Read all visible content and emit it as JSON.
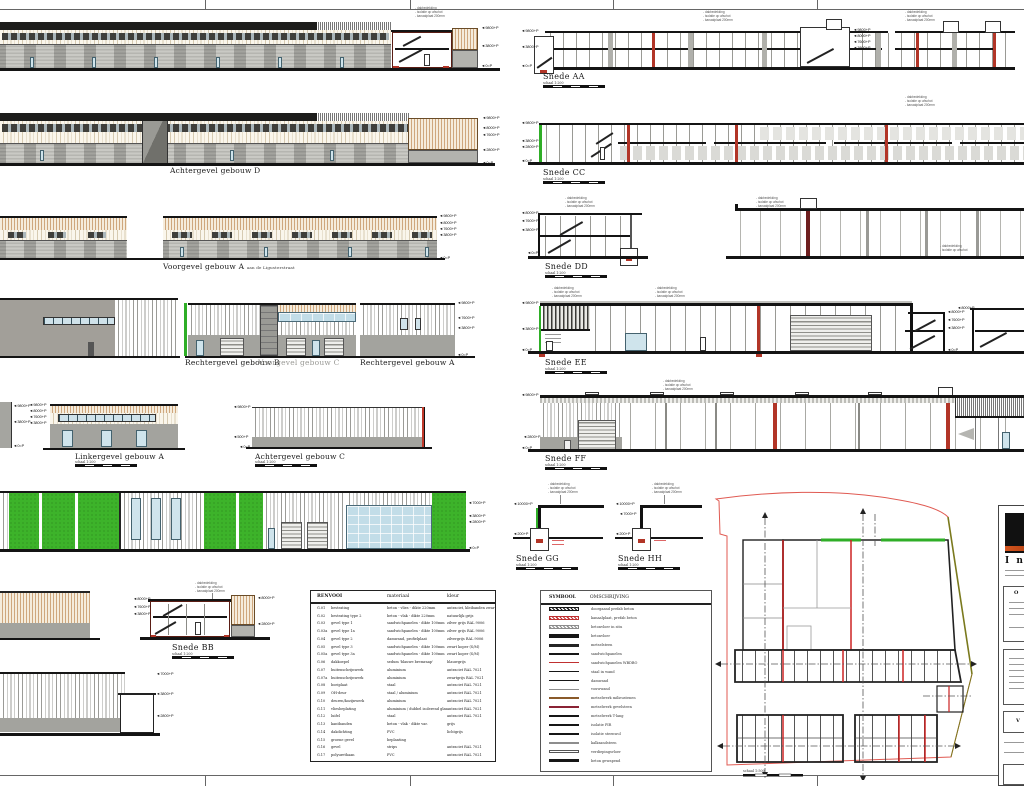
{
  "labels": {
    "achtergevel_d": "Achtergevel gebouw D",
    "voorgevel_a": "Voorgevel gebouw A",
    "voorgevel_a_suffix": "aan de Ligusterstraat",
    "rechtergevel_b": "Rechtergevel gebouw B",
    "voorgevel_c": "Voorgevel gebouw C",
    "rechtergevel_a": "Rechtergevel gebouw A",
    "linkergevel_a": "Linkergevel gebouw A",
    "achtergevel_c": "Achtergevel gebouw C"
  },
  "sections": {
    "aa": "Snede AA",
    "bb": "Snede BB",
    "cc": "Snede CC",
    "dd": "Snede DD",
    "ee": "Snede EE",
    "ff": "Snede FF",
    "gg": "Snede GG",
    "hh": "Snede HH"
  },
  "scale": {
    "label": "schaal 1:200",
    "site_label": "schaal 1:500",
    "unit": "10m"
  },
  "levels": {
    "p10000": "10000+P",
    "p9800": "9800+P",
    "p8000": "8000+P",
    "p7600": "7600+P",
    "p7000": "7000+P",
    "p3800": "3800+P",
    "p2800": "2800+P",
    "p500": "500+P",
    "p200": "200+P",
    "p0": "0=P"
  },
  "ann": {
    "l1": "- dakbedekking",
    "l2": "- isolatie op afschot",
    "l3": "- kanaalplaat 200mm"
  },
  "renvooi": {
    "title": "RENVOOI",
    "col_materiaal": "materiaal",
    "col_kleur": "kleur",
    "rows": [
      [
        "G.01",
        "bestrating",
        "beton - vlies - dikte 220mm",
        "antraciet, kleibanden zwart"
      ],
      [
        "G.02",
        "bestrating type 2",
        "beton - vlak - dikte 220mm",
        "natuurlijk grijs"
      ],
      [
        "G.03",
        "gevel type 1",
        "sandwichpanelen - dikte 100mm",
        "zilver grijs RAL 9006"
      ],
      [
        "G.03a",
        "gevel type 1a",
        "sandwichpanelen - dikte 100mm",
        "zilver grijs RAL 9006"
      ],
      [
        "G.04",
        "gevel type 2",
        "damwand, profielplaat",
        "zilvergrijs RAL 9006"
      ],
      [
        "G.05",
        "gevel type 3",
        "sandwichpanelen - dikte 100mm",
        "zwart koper (S/M)"
      ],
      [
        "G.05a",
        "gevel type 3a",
        "sandwichpanelen - dikte 100mm",
        "zwart koper (S/M)"
      ],
      [
        "G.06",
        "dakkoepel",
        "sedum 'blauwe bremraap'",
        "blauwgrijs"
      ],
      [
        "G.07",
        "buitenschrijnwerk",
        "aluminium",
        "antraciet RAL 7021"
      ],
      [
        "G.07a",
        "buitenschrijnwerk",
        "aluminium",
        "zwartgrijs RAL 7021"
      ],
      [
        "G.08",
        "boeiplaat",
        "staal",
        "antraciet RAL 7021"
      ],
      [
        "G.09",
        "OH-deur",
        "staal / aluminium",
        "antraciet RAL 7021"
      ],
      [
        "G.10",
        "deuren/kozijnwerk",
        "aluminium",
        "antraciet RAL 7021"
      ],
      [
        "G.11",
        "vliesbeplating",
        "aluminium / dubbel isolerend glas",
        "antraciet RAL 7021"
      ],
      [
        "G.12",
        "luifel",
        "staal",
        "antraciet RAL 7021"
      ],
      [
        "G.13",
        "kantbanden",
        "beton - vlak - dikte var.",
        "grijs"
      ],
      [
        "G.14",
        "dakdichting",
        "PVC",
        "lichtgrijs"
      ],
      [
        "G.15",
        "groene gevel",
        "beplanting",
        ""
      ],
      [
        "G.16",
        "gevel",
        "strips",
        "antraciet RAL 7021"
      ],
      [
        "G.17",
        "polyurethaan",
        "PVC",
        "antraciet RAL 7021"
      ]
    ]
  },
  "symbool": {
    "title": "SYMBOOL",
    "col": "OMSCHRIJVING",
    "items": [
      {
        "d": "doorgaand prefab beton",
        "s": "hatch-black"
      },
      {
        "d": "kanaalplaat, prefab beton",
        "s": "hatch-red"
      },
      {
        "d": "betonvloer in situ",
        "s": "hatch-gray"
      },
      {
        "d": "betonvloer",
        "s": "bar-black"
      },
      {
        "d": "metselsteen",
        "s": "bar-black2"
      },
      {
        "d": "sandwichpanelen",
        "s": "line-black"
      },
      {
        "d": "sandwichpanelen WBDBO",
        "s": "line-red"
      },
      {
        "d": "staal in wand",
        "s": "line-black"
      },
      {
        "d": "damwand",
        "s": "line-black"
      },
      {
        "d": "vouwwand",
        "s": "line-gray"
      },
      {
        "d": "metselwerk milieustenen",
        "s": "line-brown"
      },
      {
        "d": "metselwerk gevelsteen",
        "s": "line-darkred"
      },
      {
        "d": "metselwerk T-lang",
        "s": "bar-thin"
      },
      {
        "d": "isolatie PIR",
        "s": "bar-thin"
      },
      {
        "d": "isolatie steenwol",
        "s": "bar-thin"
      },
      {
        "d": "kalkzandsteen",
        "s": "line-gray"
      },
      {
        "d": "verdiepingsvloer",
        "s": "outline"
      },
      {
        "d": "beton gewapend",
        "s": "bar-thin"
      }
    ]
  },
  "title_block": {
    "logo": "I n",
    "h1": "O",
    "h2": "V"
  }
}
